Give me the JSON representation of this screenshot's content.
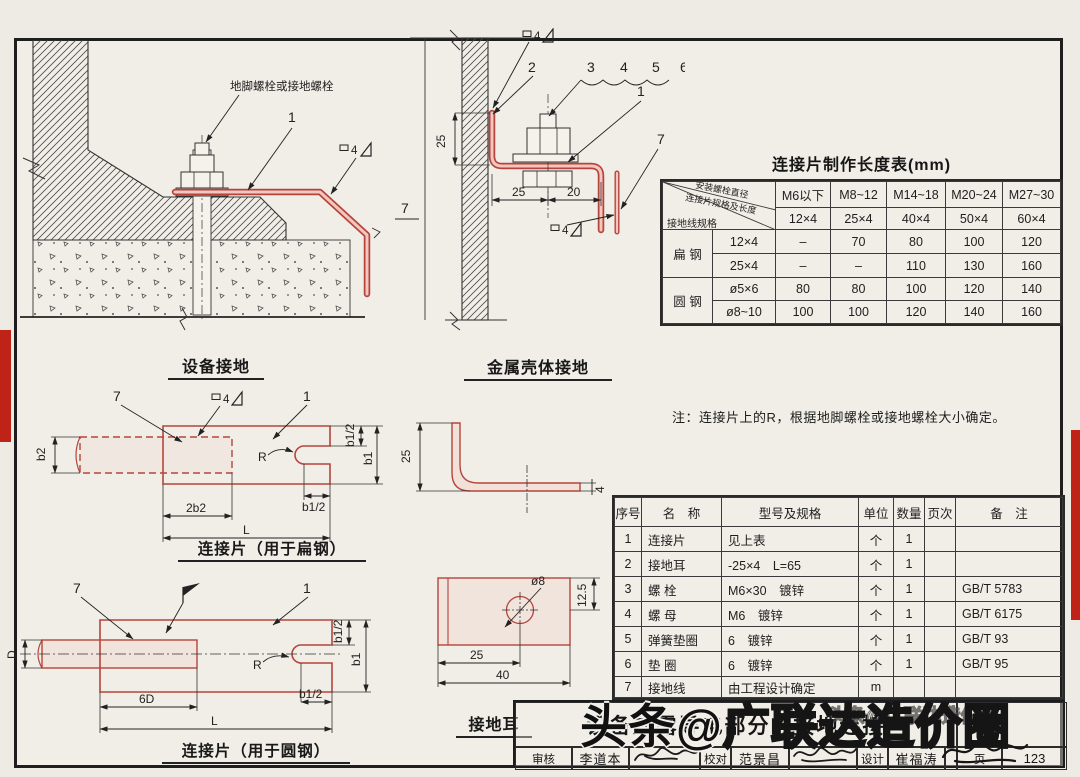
{
  "colors": {
    "paper": "#edebe4",
    "part_red": "#b5453c",
    "part_pink": "#f3c6bf",
    "edge_red": "#bf2318",
    "red_text": "#b4372c"
  },
  "drawing_equipment_ground": {
    "caption": "设备接地",
    "bolt_label": "地脚螺栓或接地螺栓",
    "callout_1": "1",
    "weld_size": "4"
  },
  "drawing_shell_ground": {
    "caption": "金属壳体接地",
    "callout_1": "1",
    "callout_2": "2",
    "callout_3": "3",
    "callout_4": "4",
    "callout_5": "5",
    "callout_6": "6",
    "callout_7": "7",
    "side_7": "7",
    "weld_size_top": "4",
    "weld_size_bottom": "4",
    "dim_v25": "25",
    "dim_25": "25",
    "dim_20": "20"
  },
  "drawing_flat": {
    "caption": "连接片（用于扁钢）",
    "callout_7": "7",
    "callout_1": "1",
    "weld_size": "4",
    "dim_b2": "b2",
    "dim_2b2": "2b2",
    "dim_L": "L",
    "dim_b1_2_top": "b1/2",
    "dim_b1": "b1",
    "dim_b1_2_bot": "b1/2",
    "dim_R": "R"
  },
  "drawing_round": {
    "caption": "连接片（用于圆钢）",
    "callout_7": "7",
    "callout_1": "1",
    "dim_D": "D",
    "dim_6D": "6D",
    "dim_L": "L",
    "dim_b1_2_top": "b1/2",
    "dim_b1": "b1",
    "dim_b1_2_bot": "b1/2",
    "dim_R": "R"
  },
  "drawing_lug": {
    "caption": "接地耳",
    "dim_25_side": "25",
    "dim_4": "4",
    "dim_hole": "ø8",
    "dim_12_5": "12.5",
    "dim_25": "25",
    "dim_40": "40"
  },
  "length_table": {
    "title": "连接片制作长度表(mm)",
    "corner_top": "安装螺栓直径",
    "corner_mid": "连接片规格及长度",
    "corner_bottom": "接地线规格",
    "col_headers": [
      "M6以下",
      "M8~12",
      "M14~18",
      "M20~24",
      "M27~30"
    ],
    "spec_row": [
      "12×4",
      "25×4",
      "40×4",
      "50×4",
      "60×4"
    ],
    "group_flat": "扁 钢",
    "group_round": "圆 钢",
    "rows": [
      {
        "spec": "12×4",
        "v": [
          "–",
          "70",
          "80",
          "100",
          "120"
        ]
      },
      {
        "spec": "25×4",
        "v": [
          "–",
          "–",
          "110",
          "130",
          "160"
        ]
      },
      {
        "spec": "ø5×6",
        "v": [
          "80",
          "80",
          "100",
          "120",
          "140"
        ]
      },
      {
        "spec": "ø8~10",
        "v": [
          "100",
          "100",
          "120",
          "140",
          "160"
        ]
      }
    ]
  },
  "note": "注：连接片上的R，根据地脚螺栓或接地螺栓大小确定。",
  "bom": {
    "headers": [
      "序号",
      "名　称",
      "型号及规格",
      "单位",
      "数量",
      "页次",
      "备　注"
    ],
    "rows": [
      {
        "no": "1",
        "name": "连接片",
        "spec": "见上表",
        "unit": "个",
        "qty": "1",
        "page": "",
        "remark": ""
      },
      {
        "no": "2",
        "name": "接地耳",
        "spec": "-25×4　L=65",
        "unit": "个",
        "qty": "1",
        "page": "",
        "remark": ""
      },
      {
        "no": "3",
        "name": "螺 栓",
        "spec": "M6×30　镀锌",
        "unit": "个",
        "qty": "1",
        "page": "",
        "remark": "GB/T 5783"
      },
      {
        "no": "4",
        "name": "螺 母",
        "spec": "M6　镀锌",
        "unit": "个",
        "qty": "1",
        "page": "",
        "remark": "GB/T 6175"
      },
      {
        "no": "5",
        "name": "弹簧垫圈",
        "spec": "6　镀锌",
        "unit": "个",
        "qty": "1",
        "page": "",
        "remark": "GB/T 93"
      },
      {
        "no": "6",
        "name": "垫 圈",
        "spec": "6　镀锌",
        "unit": "个",
        "qty": "1",
        "page": "",
        "remark": "GB/T 95"
      },
      {
        "no": "7",
        "name": "接地线",
        "spec": "由工程设计确定",
        "unit": "m",
        "qty": "",
        "page": "",
        "remark": ""
      }
    ]
  },
  "title_block": {
    "title": "设备外露导电部分的接地连接",
    "audit_label": "审核",
    "audit_name": "李道本",
    "check_label": "校对",
    "check_name": "范景昌",
    "design_label": "设计",
    "design_name": "崔福涛",
    "page_label": "页",
    "page_number": "123"
  },
  "watermark": {
    "main_solid": "头条@",
    "main_hollow": "广联达造价圈",
    "small": "头条@广联达造价圈"
  }
}
